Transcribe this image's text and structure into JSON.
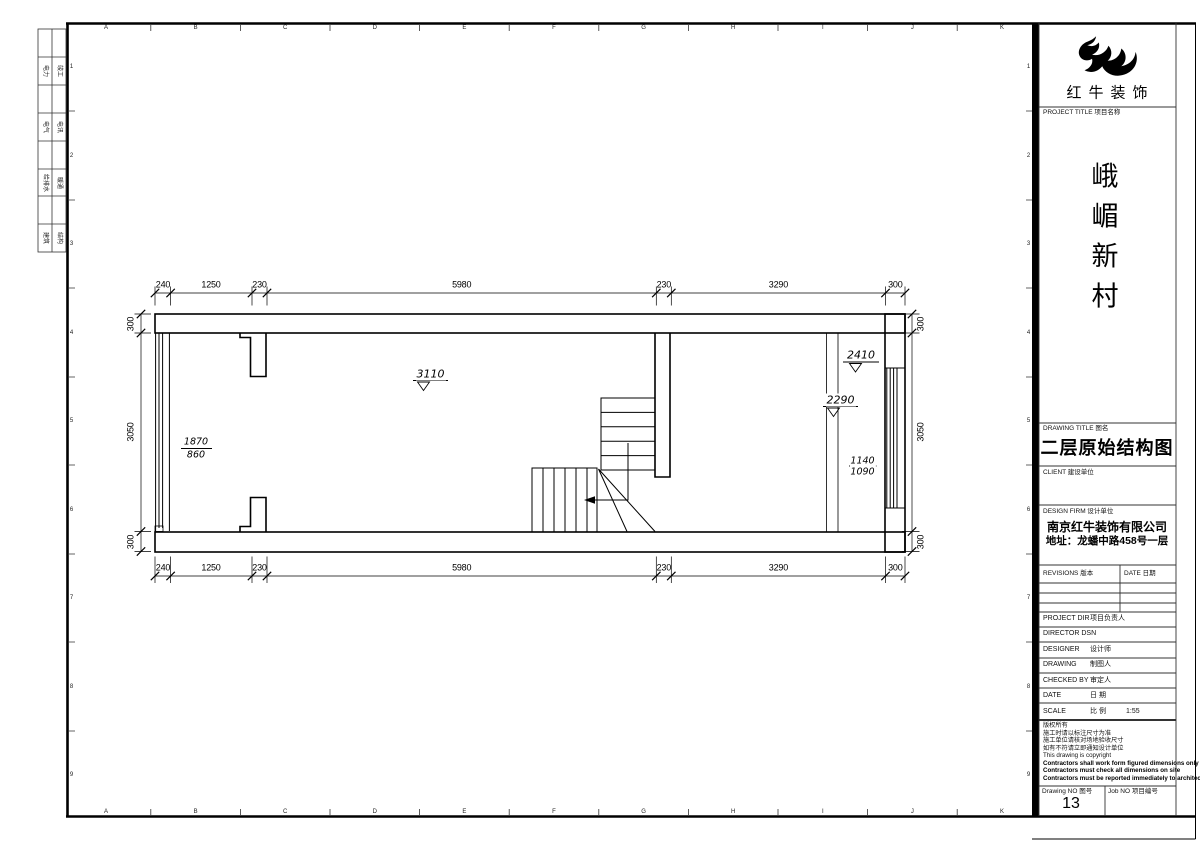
{
  "sheet": {
    "grid_letters": [
      "A",
      "B",
      "C",
      "D",
      "E",
      "F",
      "G",
      "H",
      "I",
      "J",
      "K"
    ],
    "grid_numbers": [
      "1",
      "2",
      "3",
      "4",
      "5",
      "6",
      "7",
      "8",
      "9"
    ],
    "signoff_rows": [
      {
        "c1": "电力",
        "c2": "竣工"
      },
      {
        "c1": "电气",
        "c2": "电讯"
      },
      {
        "c1": "给排水",
        "c2": "暖通"
      },
      {
        "c1": "建筑",
        "c2": "结构"
      }
    ]
  },
  "plan": {
    "dims_h": [
      "240",
      "1250",
      "230",
      "5980",
      "230",
      "3290",
      "300"
    ],
    "dims_v": [
      "300",
      "3050",
      "300"
    ],
    "levels": {
      "room_left": "3110",
      "right_upper": "2410",
      "right_mid": "2290"
    },
    "fractions": {
      "left_top": "1870",
      "left_bottom": "860",
      "right_top": "1140",
      "right_bottom": "1090"
    }
  },
  "titleblock": {
    "logo_text": "红牛装饰",
    "project_title_label": "PROJECT TITLE  项目名称",
    "project_name_chars": [
      "峨",
      "嵋",
      "新",
      "村"
    ],
    "drawing_title_label": "DRAWING TITLE  图名",
    "drawing_title": "二层原始结构图",
    "client_label": "CLIENT 建设单位",
    "design_firm_label": "DESIGN FIRM  设计单位",
    "design_firm_name": "南京红牛装饰有限公司",
    "design_firm_address": "地址：龙蟠中路458号一层",
    "revisions_label": "REVISIONS 版本",
    "date_label": "DATE 日期",
    "fields": [
      {
        "en": "PROJECT DIR",
        "cn": "项目负责人"
      },
      {
        "en": "DIRECTOR DSN",
        "cn": ""
      },
      {
        "en": "DESIGNER",
        "cn": "设计师"
      },
      {
        "en": "DRAWING",
        "cn": "制图人"
      },
      {
        "en": "CHECKED BY",
        "cn": "审定人"
      },
      {
        "en": "DATE",
        "cn": "日 期"
      },
      {
        "en": "SCALE",
        "cn": "比 例"
      }
    ],
    "scale_value": "1:55",
    "notes": [
      "版权所有",
      "施工时请以标注尺寸为准",
      "施工单位请核对场地验收尺寸",
      "如有不符请立即通知设计单位",
      "This drawing is copyright",
      "Contractors shall work form figured dimensions only",
      "Contractors must check all dimensions on site",
      "Contractors must be reported immediately to architects"
    ],
    "drawing_no_label": "Drawing NO 图号",
    "drawing_no": "13",
    "job_no_label": "Job NO 项目编号"
  }
}
